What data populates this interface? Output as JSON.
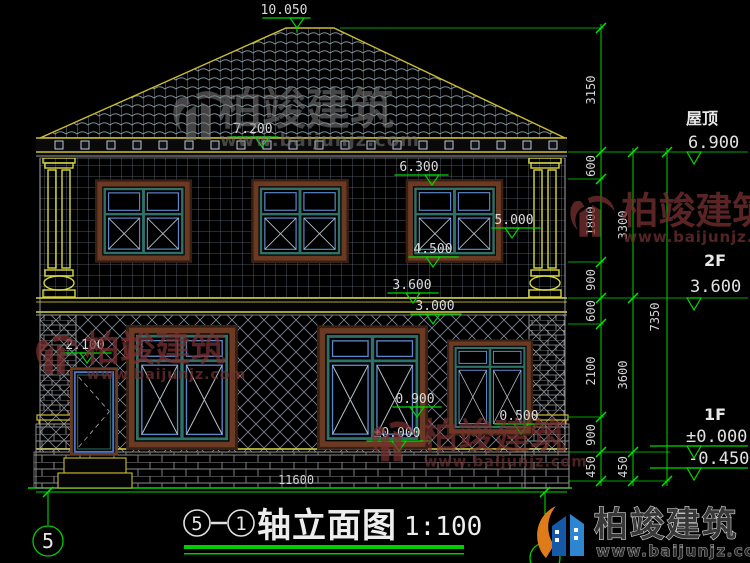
{
  "drawing": {
    "titleblock": {
      "bubble_left": "5",
      "bubble_right": "1",
      "name": "轴立面图",
      "scale": "1:100"
    },
    "axis_left": "5",
    "markers": {
      "peak": "10.050",
      "roof_mid": "7.200",
      "eave": "6.300",
      "win_top": "5.000",
      "win_sill": "4.500",
      "floor2": "3.600",
      "ceil1": "3.000",
      "door_top": "2.100",
      "sill1": "0.900",
      "base": "0.500",
      "zero": "±0.000"
    },
    "levels": {
      "roof_label": "屋顶",
      "roof_value": "6.900",
      "f2_label": "2F",
      "f2_value": "3.600",
      "f1_label": "1F",
      "f1_value": "±0.000",
      "f1_below": "-0.450"
    },
    "dims": {
      "chain1": [
        "3150",
        "600",
        "1800",
        "900",
        "600",
        "2100",
        "900",
        "450"
      ],
      "chain2": [
        "3300",
        "3600",
        "450"
      ],
      "chain3": [
        "7350"
      ],
      "bottom": "11600"
    },
    "colors": {
      "cad_green": "#00d800",
      "trim_yellow": "#cdbd30",
      "frame_brown": "#6a3a22",
      "window_teal": "#2e7168",
      "watermark_maroon": "#7a3030",
      "logo_orange": "#e07b1a",
      "logo_blue_dark": "#1558a8",
      "logo_blue_light": "#2f86d0"
    }
  },
  "brand": {
    "name": "柏竣建筑",
    "site": "www.baijunjz.com"
  }
}
